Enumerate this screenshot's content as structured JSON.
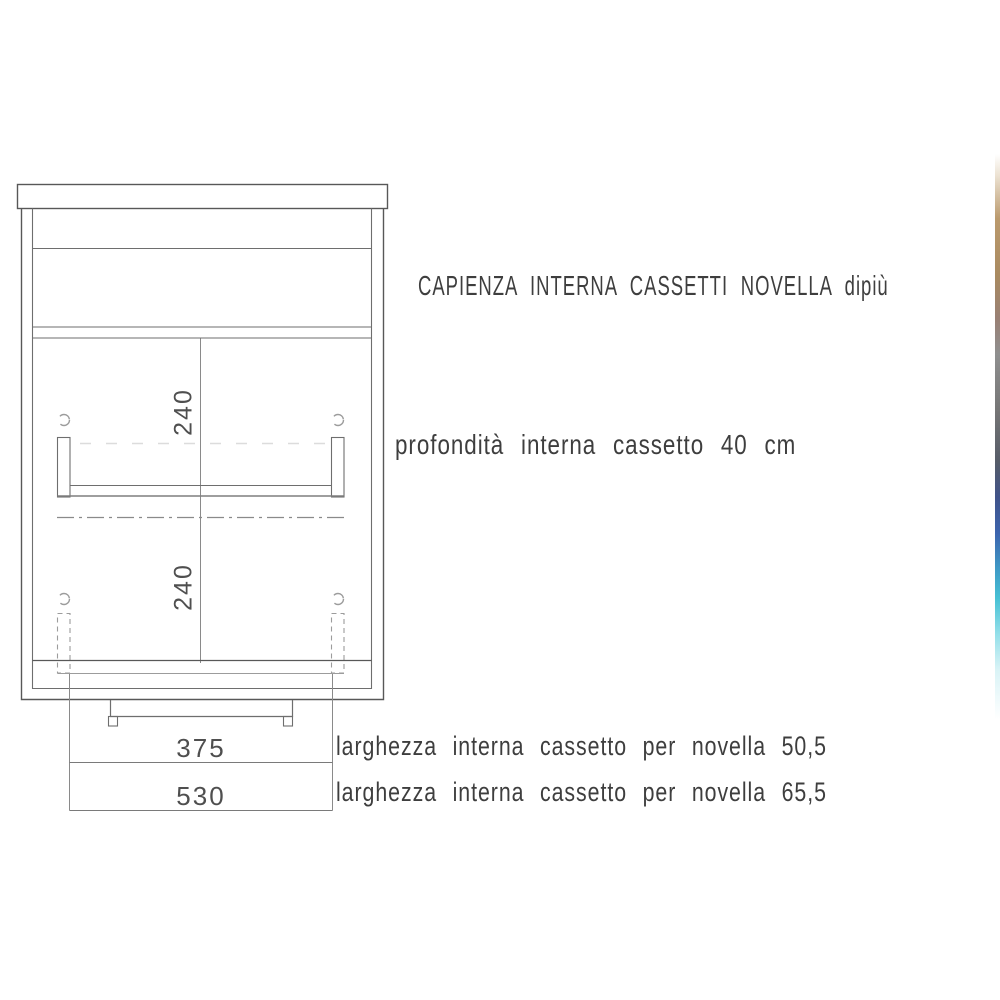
{
  "document": {
    "title": "CAPIENZA INTERNA CASSETTI NOVELLA dipiù",
    "notes": {
      "depth": "profondità interna cassetto 40 cm",
      "width_small": "larghezza interna cassetto per novella 50,5",
      "width_large": "larghezza interna cassetto per novella 65,5"
    },
    "dimensions": {
      "upper_drawer_height": "240",
      "lower_drawer_height": "240",
      "inner_width": "375",
      "outer_width": "530"
    }
  },
  "drawing": {
    "type": "furniture front-section technical drawing",
    "subject": "cabinet with two internal drawers, countertop and plinth"
  },
  "colors": {
    "background": "#ffffff",
    "line_dark": "#585858",
    "line_medium": "#7a7a7a",
    "line_light": "#9c9c9c",
    "line_faint": "#d9d9d9",
    "text": "#3e3e3e",
    "edge_strip_gradient": [
      "#ffffff 0%",
      "#ece2d2 3%",
      "#bb9a6d 9%",
      "#a98a60 17%",
      "#998074 23%",
      "#8f8f8f 28%",
      "#757575 36%",
      "#565c68 43%",
      "#40538a 48%",
      "#3c64ae 53%",
      "#3f9ac6 58%",
      "#46c0d4 62%",
      "#93dfe9 67%",
      "#d9f3f6 72%",
      "#ffffff 79%",
      "#ffffff 100%"
    ]
  }
}
